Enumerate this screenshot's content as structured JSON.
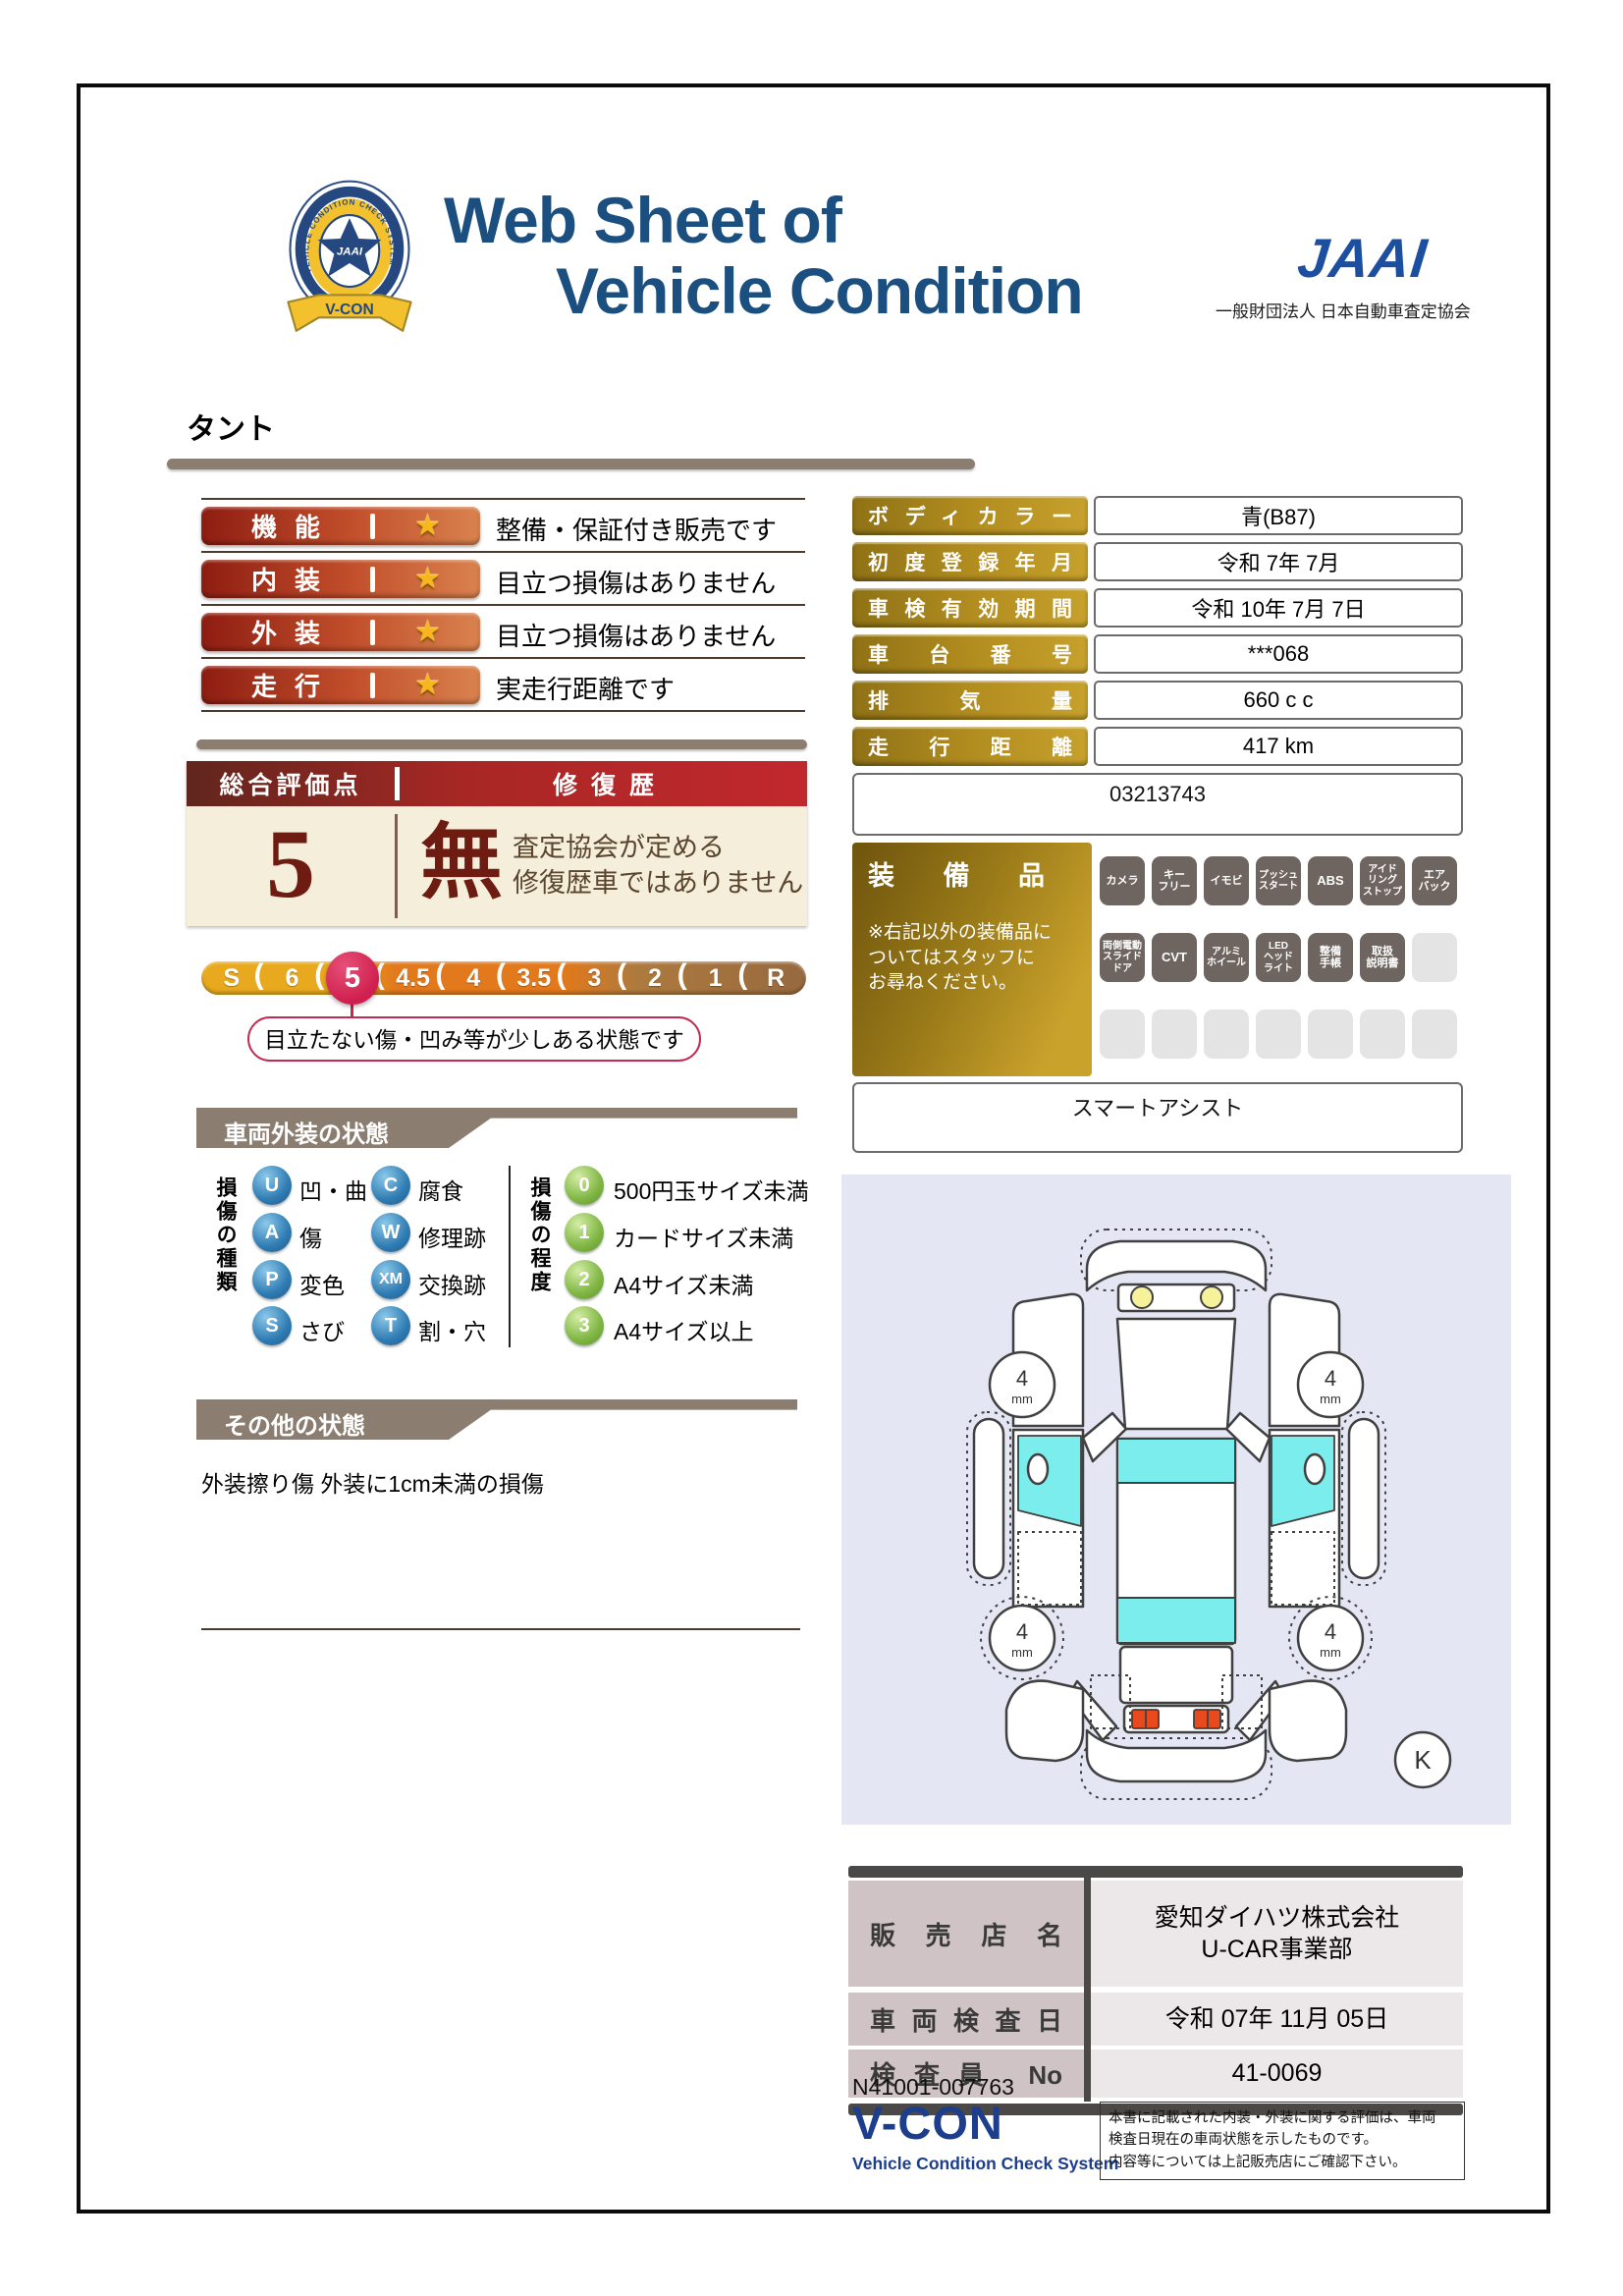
{
  "header": {
    "title_line1": "Web Sheet of",
    "title_line2": "Vehicle Condition",
    "jaai_logo_text": "JAAI",
    "jaai_org": "一般財団法人 日本自動車査定協会",
    "badge_ribbon": "V-CON",
    "badge_ring_text": "VEHICLE CONDITION CHECK SYSTEM",
    "badge_star_text": "JAAI"
  },
  "vehicle_name": "タント",
  "ratings": {
    "star": "★",
    "rows": [
      {
        "label": "機能",
        "comment": "整備・保証付き販売です"
      },
      {
        "label": "内装",
        "comment": "目立つ損傷はありません"
      },
      {
        "label": "外装",
        "comment": "目立つ損傷はありません"
      },
      {
        "label": "走行",
        "comment": "実走行距離です"
      }
    ]
  },
  "info_table": {
    "rows": [
      {
        "label": "ボディカラー",
        "value": "青(B87)"
      },
      {
        "label": "初度登録年月",
        "value": "令和 7年 7月"
      },
      {
        "label": "車検有効期間",
        "value": "令和 10年 7月 7日"
      },
      {
        "label": "車台番号",
        "value": "***068"
      },
      {
        "label": "排気量",
        "value": "660 c c"
      },
      {
        "label": "走行距離",
        "value": "417 km"
      }
    ],
    "reference_number": "03213743"
  },
  "overall": {
    "score_header": "総合評価点",
    "repair_header": "修復歴",
    "score": "5",
    "repair_value": "無",
    "repair_note": "査定協会が定める\n修復歴車ではありません"
  },
  "scale": {
    "separator": "(",
    "values": [
      "S",
      "6",
      "5",
      "4.5",
      "4",
      "3.5",
      "3",
      "2",
      "1",
      "R"
    ],
    "selected_value": "5",
    "selected_note": "目立たない傷・凹み等が少しある状態です"
  },
  "equipment": {
    "title": "装備品",
    "note": "※右記以外の装備品に\nついてはスタッフに\nお尋ねください。",
    "row1": [
      "カメラ",
      "キー\nフリー",
      "イモビ",
      "プッシュ\nスタート",
      "ABS",
      "アイド\nリング\nストップ",
      "エア\nバック"
    ],
    "row2": [
      "両側電動\nスライド\nドア",
      "CVT",
      "アルミ\nホイール",
      "LED\nヘッド\nライト",
      "整備\n手帳",
      "取扱\n説明書"
    ],
    "extra_item": "スマートアシスト"
  },
  "exterior": {
    "section_title": "車両外装の状態",
    "types_label": "損傷の種類",
    "types": [
      {
        "code": "U",
        "label": "凹・曲"
      },
      {
        "code": "A",
        "label": "傷"
      },
      {
        "code": "P",
        "label": "変色"
      },
      {
        "code": "S",
        "label": "さび"
      },
      {
        "code": "C",
        "label": "腐食"
      },
      {
        "code": "W",
        "label": "修理跡"
      },
      {
        "code": "XM",
        "label": "交換跡"
      },
      {
        "code": "T",
        "label": "割・穴"
      }
    ],
    "levels_label": "損傷の程度",
    "levels": [
      {
        "code": "0",
        "label": "500円玉サイズ未満"
      },
      {
        "code": "1",
        "label": "カードサイズ未満"
      },
      {
        "code": "2",
        "label": "A4サイズ未満"
      },
      {
        "code": "3",
        "label": "A4サイズ以上"
      }
    ],
    "tire_tread_value": "4",
    "tire_tread_unit": "mm",
    "diagram_marker": "K"
  },
  "other": {
    "section_title": "その他の状態",
    "text": "外装擦り傷 外装に1cm未満の損傷"
  },
  "dealer": {
    "rows": [
      {
        "label": "販売店名",
        "value": "愛知ダイハツ株式会社\nU-CAR事業部"
      },
      {
        "label": "車両検査日",
        "value": "令和 07年 11月 05日"
      },
      {
        "label": "検査員 No",
        "value": "41-0069"
      }
    ]
  },
  "footer": {
    "doc_number": "N41001-007763",
    "vcon_logo": "V-CON",
    "vcon_subtitle": "Vehicle Condition Check System",
    "disclaimer": "本書に記載された内装・外装に関する評価は、車両\n検査日現在の車両状態を示したものです。\n内容等については上記販売店にご確認下さい。"
  },
  "colors": {
    "title_navy": "#1a4f80",
    "jaai_blue": "#1d4fa1",
    "taupe": "#8b7e71",
    "pill_red": "#8e1d12",
    "pill_orange": "#d9824e",
    "gold_dark": "#8f7216",
    "gold_light": "#c7a12c",
    "header_red": "#c1282e",
    "cream": "#f4eeda",
    "dark_red_text": "#6e1c12",
    "crimson": "#cf1f4e",
    "scale_gold": "#e9a91e",
    "scale_orange": "#e2791c",
    "scale_brown": "#97693f",
    "badge_gray": "#6e6460",
    "lavender": "#e4e6f4",
    "window_cyan": "#7ceded",
    "mauve": "#d0c3c6",
    "footer_navy": "#1c3e8c"
  }
}
